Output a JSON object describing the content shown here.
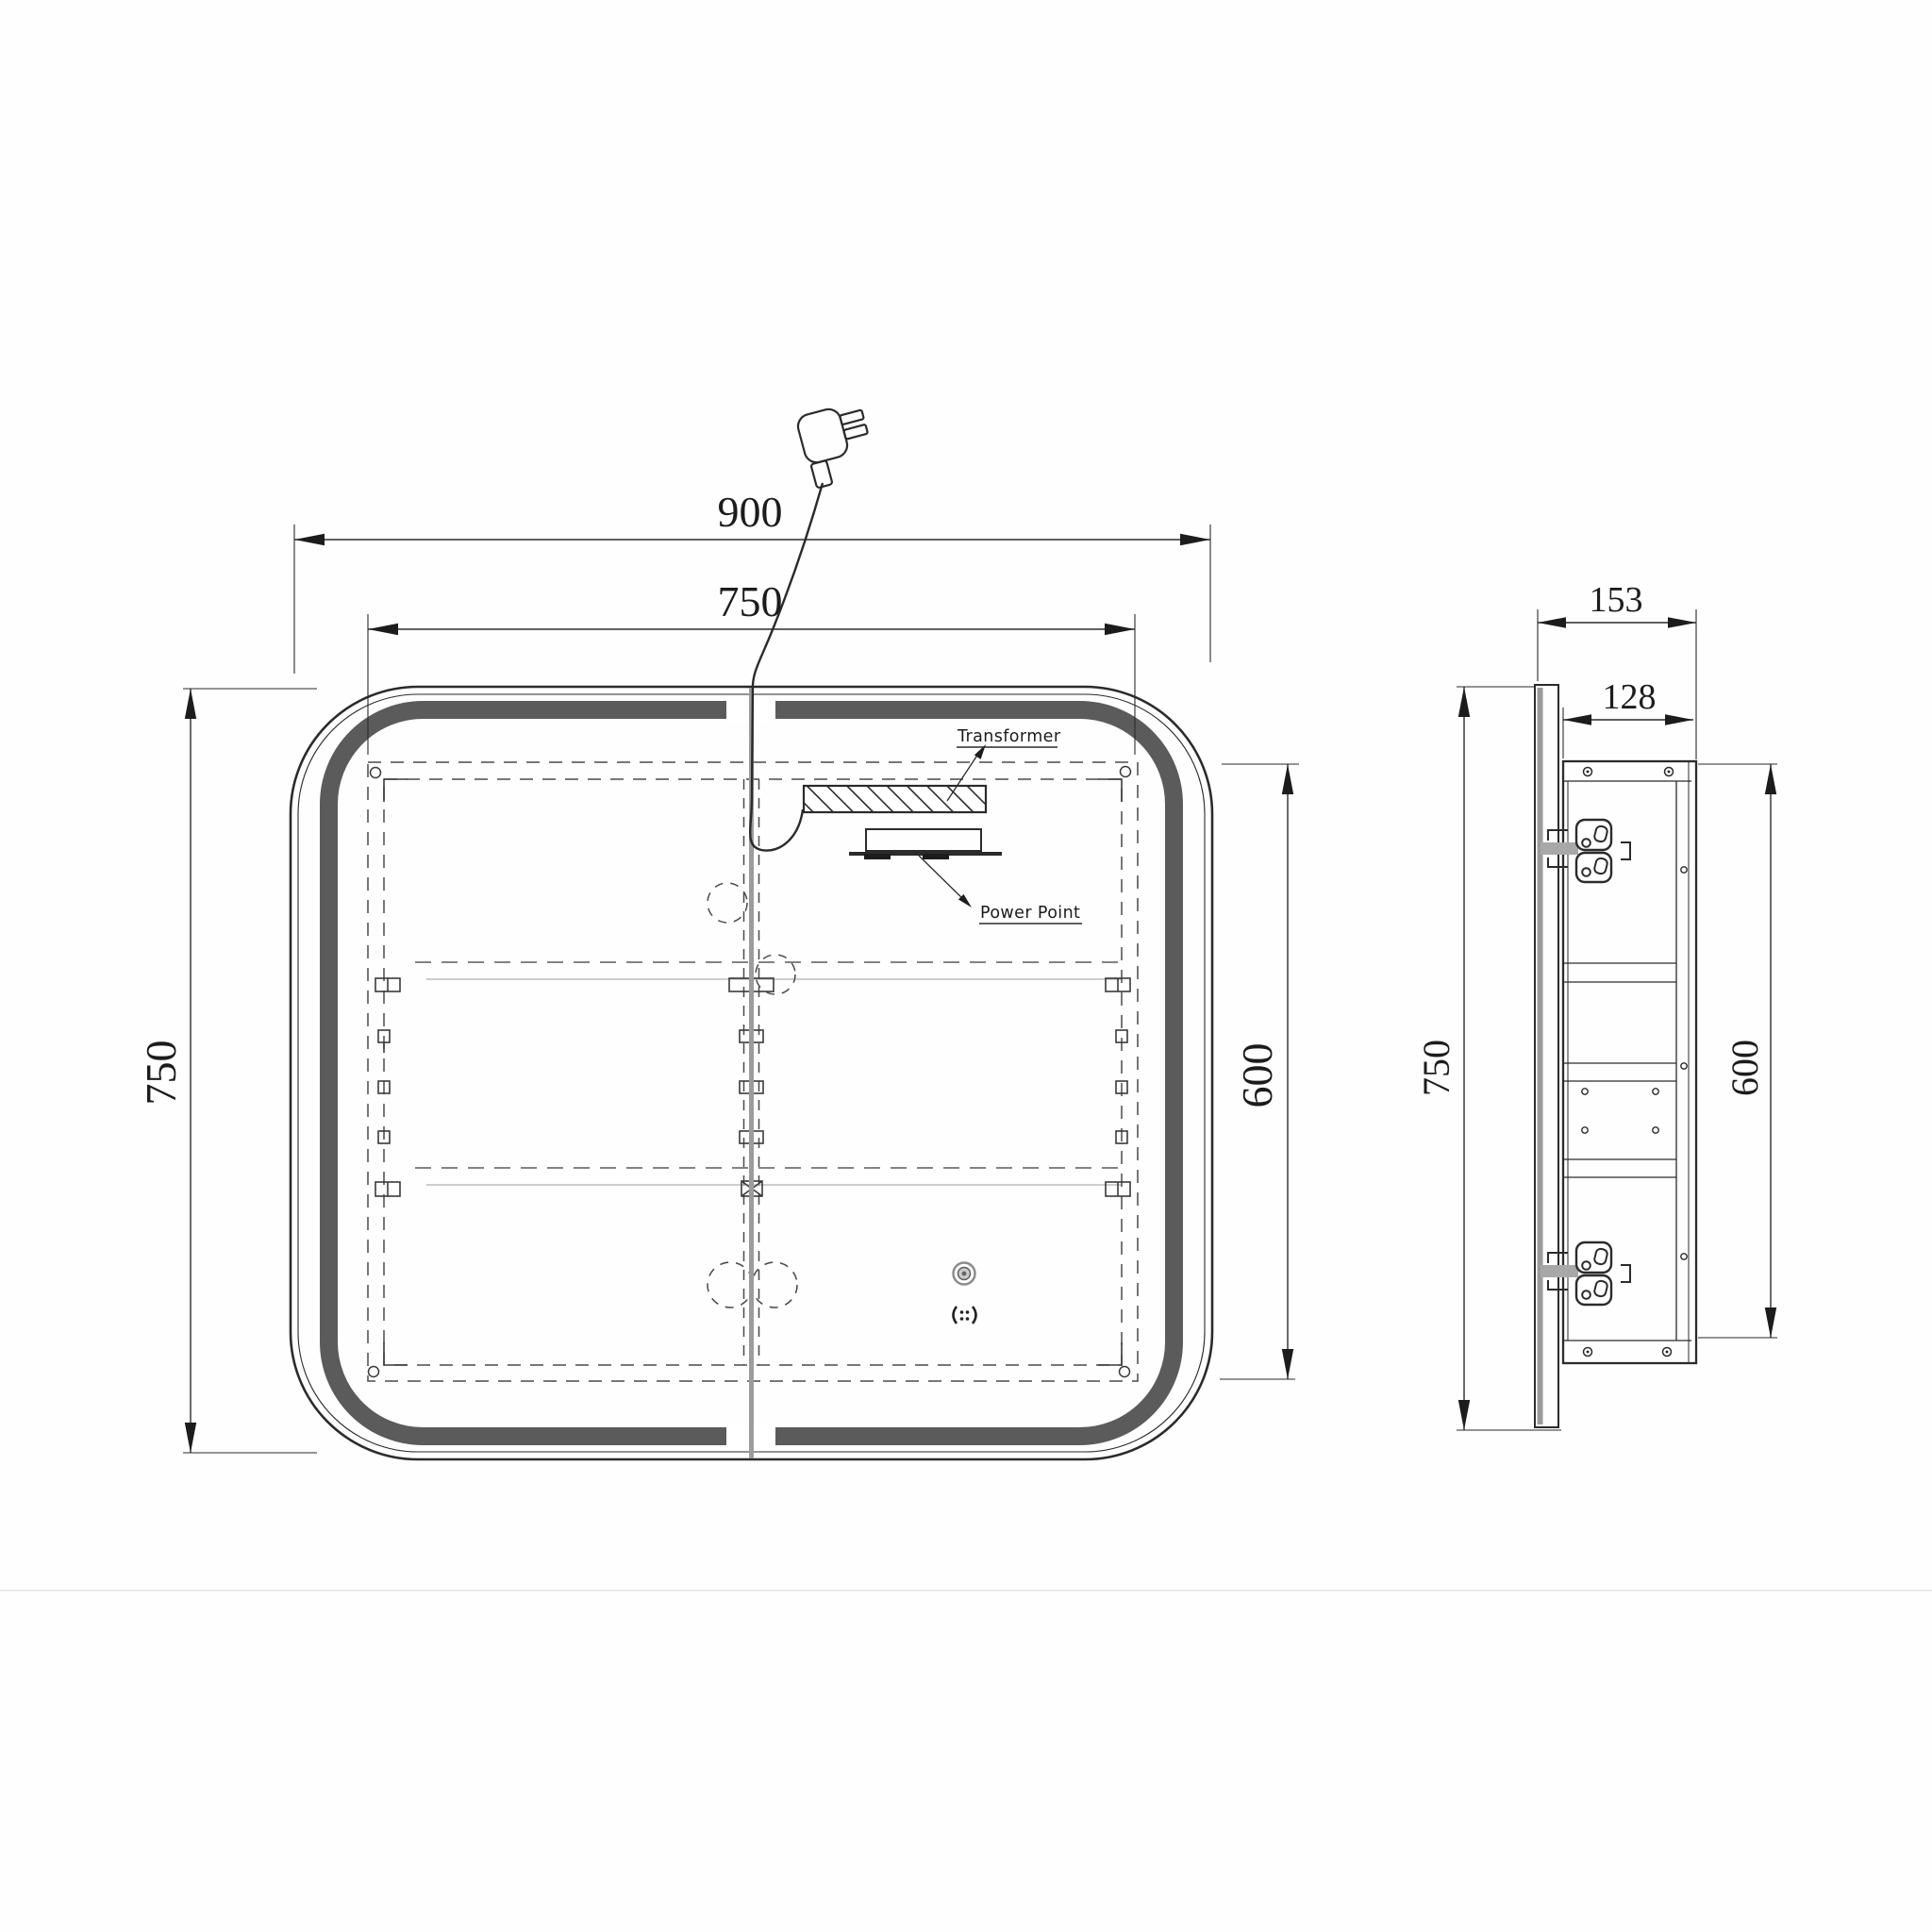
{
  "drawing": {
    "kind": "mirror-cabinet-dimension-diagram",
    "front_view": {
      "dims": {
        "overall_width": "900",
        "inner_width": "750",
        "overall_height": "750",
        "inner_height": "600"
      },
      "callouts": {
        "transformer": "Transformer",
        "power_point": "Power Point"
      },
      "icons": [
        "plug-icon",
        "power-cord",
        "touch-sensor-icon",
        "defogger-icon"
      ]
    },
    "side_view": {
      "dims": {
        "overall_depth": "153",
        "cabinet_depth": "128",
        "overall_height": "750",
        "cabinet_height": "600"
      },
      "icons": [
        "outlet-icon"
      ]
    },
    "colors": {
      "background": "#fefefe",
      "line": "#2b2b2b",
      "dash": "#4a4a4a",
      "led_band": "#5b5b5b",
      "door_gap": "#9c9c9c",
      "mirror_edge_gray": "#9a9a9a",
      "faint_shelf": "#b2b2b2",
      "separator": "#ebebe8"
    }
  }
}
